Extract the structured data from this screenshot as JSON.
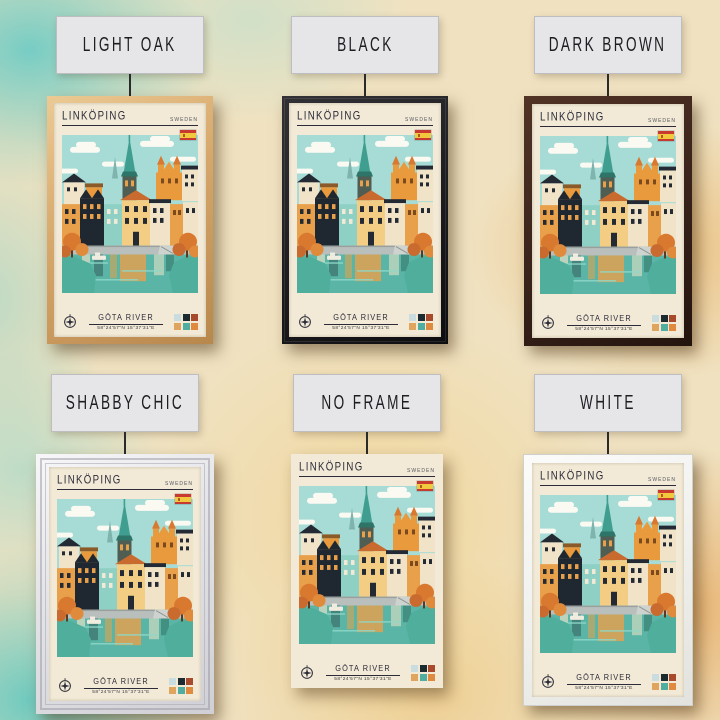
{
  "variants": [
    {
      "label": "LIGHT OAK",
      "frame": "light-oak"
    },
    {
      "label": "BLACK",
      "frame": "black"
    },
    {
      "label": "DARK BROWN",
      "frame": "dark-brown"
    },
    {
      "label": "SHABBY CHIC",
      "frame": "shabby-chic"
    },
    {
      "label": "NO FRAME",
      "frame": "none"
    },
    {
      "label": "WHITE",
      "frame": "white"
    }
  ],
  "poster": {
    "title": "LINKÖPING",
    "country": "SWEDEN",
    "subtitle": "GÖTA RIVER",
    "coordinates": "58°24'57\"N 15°37'31\"E",
    "icons": {
      "flag": "spain-flag-icon",
      "compass": "compass-icon"
    },
    "palette": [
      "#c9dde0",
      "#1c2b30",
      "#a84a2c",
      "#dfa45e",
      "#4fae9f",
      "#df8a3e"
    ]
  },
  "frame_colors": {
    "light-oak": "#d6a76a",
    "black": "#1b1b1e",
    "dark-brown": "#38221a",
    "shabby-chic": "#e3e3e7",
    "white": "#efefec"
  }
}
